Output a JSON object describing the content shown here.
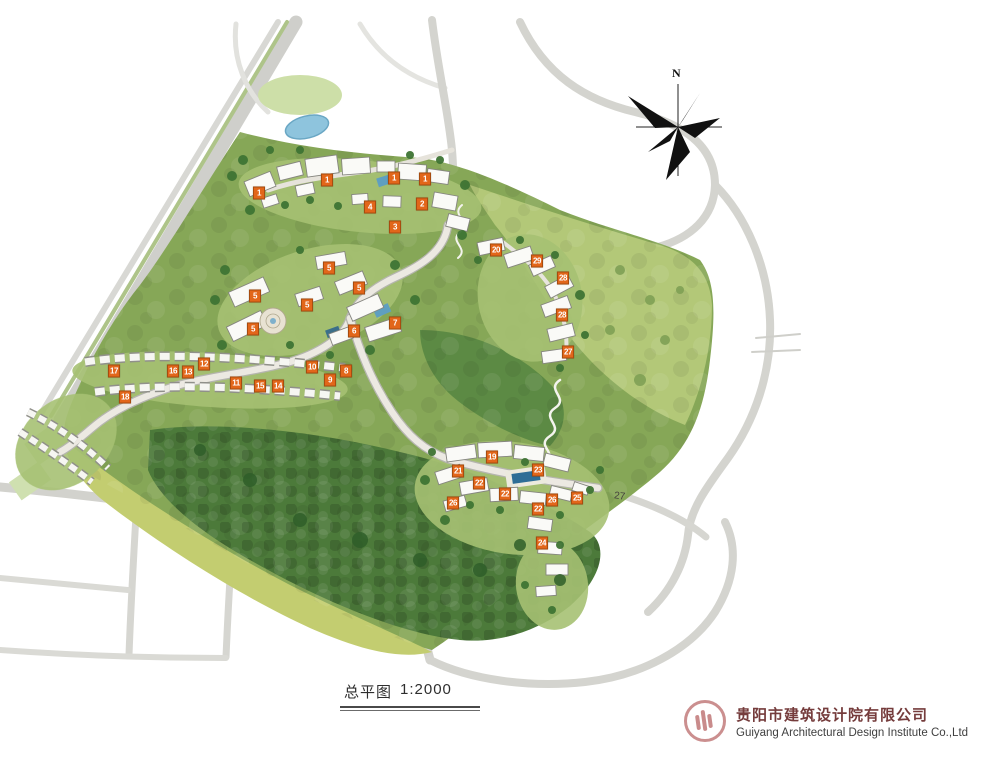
{
  "map": {
    "north_label": "N",
    "road_label": "27",
    "marker_color": "#e2661a",
    "markers": [
      {
        "label": "1",
        "x": 259,
        "y": 193
      },
      {
        "label": "1",
        "x": 327,
        "y": 180
      },
      {
        "label": "1",
        "x": 394,
        "y": 178
      },
      {
        "label": "1",
        "x": 425,
        "y": 179
      },
      {
        "label": "4",
        "x": 370,
        "y": 207
      },
      {
        "label": "2",
        "x": 422,
        "y": 204
      },
      {
        "label": "3",
        "x": 395,
        "y": 227
      },
      {
        "label": "5",
        "x": 329,
        "y": 268
      },
      {
        "label": "5",
        "x": 359,
        "y": 288
      },
      {
        "label": "5",
        "x": 307,
        "y": 305
      },
      {
        "label": "5",
        "x": 255,
        "y": 296
      },
      {
        "label": "5",
        "x": 253,
        "y": 329
      },
      {
        "label": "6",
        "x": 354,
        "y": 331
      },
      {
        "label": "7",
        "x": 395,
        "y": 323
      },
      {
        "label": "17",
        "x": 114,
        "y": 371
      },
      {
        "label": "18",
        "x": 125,
        "y": 397
      },
      {
        "label": "16",
        "x": 173,
        "y": 371
      },
      {
        "label": "13",
        "x": 188,
        "y": 372
      },
      {
        "label": "12",
        "x": 204,
        "y": 364
      },
      {
        "label": "11",
        "x": 236,
        "y": 383
      },
      {
        "label": "15",
        "x": 260,
        "y": 386
      },
      {
        "label": "14",
        "x": 278,
        "y": 386
      },
      {
        "label": "10",
        "x": 312,
        "y": 367
      },
      {
        "label": "9",
        "x": 330,
        "y": 380
      },
      {
        "label": "8",
        "x": 346,
        "y": 371
      },
      {
        "label": "20",
        "x": 496,
        "y": 250
      },
      {
        "label": "29",
        "x": 537,
        "y": 261
      },
      {
        "label": "28",
        "x": 563,
        "y": 278
      },
      {
        "label": "28",
        "x": 562,
        "y": 315
      },
      {
        "label": "27",
        "x": 568,
        "y": 352
      },
      {
        "label": "19",
        "x": 492,
        "y": 457
      },
      {
        "label": "23",
        "x": 538,
        "y": 470
      },
      {
        "label": "21",
        "x": 458,
        "y": 471
      },
      {
        "label": "22",
        "x": 479,
        "y": 483
      },
      {
        "label": "22",
        "x": 505,
        "y": 494
      },
      {
        "label": "26",
        "x": 453,
        "y": 503
      },
      {
        "label": "26",
        "x": 552,
        "y": 500
      },
      {
        "label": "25",
        "x": 577,
        "y": 498
      },
      {
        "label": "22",
        "x": 538,
        "y": 509
      },
      {
        "label": "24",
        "x": 542,
        "y": 543
      }
    ]
  },
  "caption": {
    "title": "总平图",
    "scale": "1:2000"
  },
  "footer": {
    "company_cn": "贵阳市建筑设计院有限公司",
    "company_en": "Guiyang Architectural Design Institute Co.,Ltd",
    "logo_color": "#cb8f8f"
  },
  "colors": {
    "site_green": "#86a757",
    "forest_green": "#4c7a3a",
    "meadow_green": "#b3c878",
    "field_yellow": "#c3cd70",
    "road_gray": "#d6d6d2",
    "pond_blue": "#8ec4dd",
    "company_text": "#753c3c"
  }
}
